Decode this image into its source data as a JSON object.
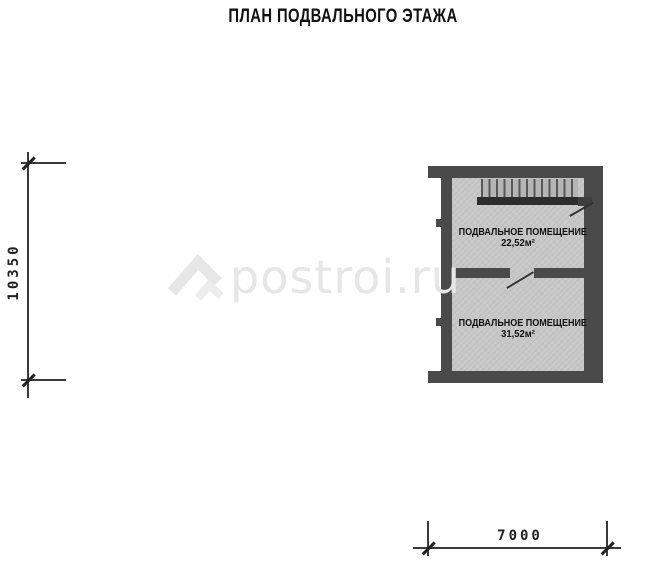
{
  "page": {
    "title": "ПЛАН ПОДВАЛЬНОГО ЭТАЖА"
  },
  "watermark": {
    "text": "postroi.ru",
    "logo": "roof-logo-icon"
  },
  "dimensions": {
    "left": {
      "value": "10350",
      "orientation": "vertical"
    },
    "bottom": {
      "value": "7000",
      "orientation": "horizontal"
    }
  },
  "plan": {
    "type": "basement-floor-plan",
    "rooms": [
      {
        "label": "ПОДВАЛЬНОЕ ПОМЕЩЕНИЕ",
        "area": "22,52м²"
      },
      {
        "label": "ПОДВАЛЬНОЕ ПОМЕЩЕНИЕ",
        "area": "31,52м²"
      }
    ],
    "stairs": {
      "treads": 13,
      "position": "top-of-upper-room"
    },
    "doors": 2
  },
  "colors": {
    "wall": "#4a4a4a",
    "wall-dark": "#2d2d2d",
    "floor": "#c7c7c7",
    "line": "#3a3a3a",
    "text": "#111111",
    "watermark": "#e6e6e6"
  }
}
